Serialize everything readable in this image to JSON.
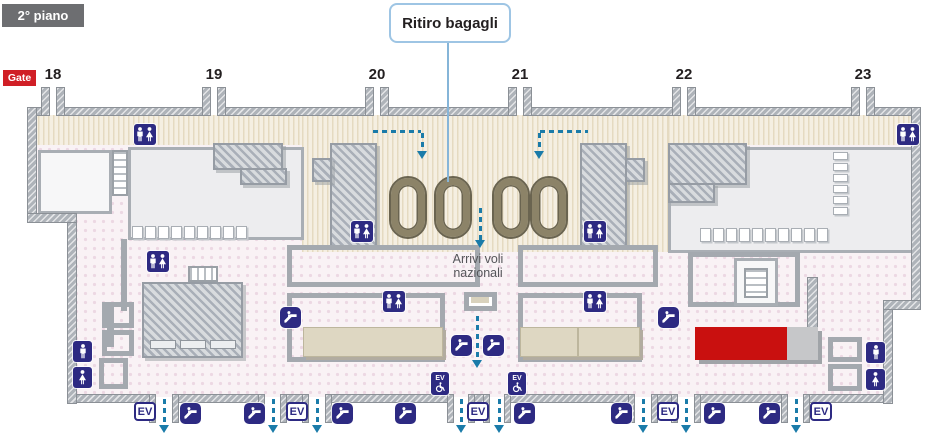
{
  "title": {
    "floor_label": "2° piano"
  },
  "callout": {
    "ritiro_bagagli": "Ritiro bagagli"
  },
  "annotations": {
    "arrivi_line1": "Arrivi voli",
    "arrivi_line2": "nazionali"
  },
  "gate": {
    "tag": "Gate",
    "numbers": [
      {
        "n": "18",
        "cx": 53,
        "gap": 49
      },
      {
        "n": "19",
        "cx": 214,
        "gap": 210
      },
      {
        "n": "20",
        "cx": 377,
        "gap": 373
      },
      {
        "n": "21",
        "cx": 520,
        "gap": 516
      },
      {
        "n": "22",
        "cx": 684,
        "gap": 680
      },
      {
        "n": "23",
        "cx": 863,
        "gap": 859
      }
    ],
    "gap_width": 8
  },
  "labels": {
    "ev": "EV"
  },
  "colors": {
    "icon_navy": "#2d2a82",
    "gate_red": "#d01f26",
    "highlight_red": "#c9100f",
    "arrow_blue": "#1a7ba9",
    "callout_border": "#9ec5e4",
    "corridor_beige": "#f5efe2",
    "floor_pink": "#f9f2f5",
    "wall_gray": "#aeb3b9",
    "carousel_olive": "#8c8368",
    "floor_label_gray": "#6d6e71"
  },
  "map": {
    "walls": {
      "top_y": 108,
      "top_segments": [
        [
          28,
          49
        ],
        [
          57,
          210
        ],
        [
          218,
          373
        ],
        [
          381,
          516
        ],
        [
          524,
          680
        ],
        [
          688,
          859
        ],
        [
          867,
          920
        ]
      ],
      "bottom_y": 395,
      "bottom_segments": [
        [
          68,
          155
        ],
        [
          173,
          264
        ],
        [
          281,
          308
        ],
        [
          326,
          453
        ],
        [
          469,
          489
        ],
        [
          505,
          634
        ],
        [
          652,
          677
        ],
        [
          695,
          787
        ],
        [
          804,
          888
        ]
      ],
      "bottom_gaps": [
        [
          155,
          173
        ],
        [
          264,
          281
        ],
        [
          308,
          326
        ],
        [
          453,
          469
        ],
        [
          489,
          505
        ],
        [
          634,
          652
        ],
        [
          677,
          695
        ],
        [
          787,
          804
        ]
      ],
      "verticals": [
        [
          28,
          108,
          113
        ],
        [
          68,
          214,
          189
        ],
        [
          912,
          108,
          200
        ],
        [
          884,
          301,
          102
        ]
      ],
      "jogs": [
        [
          28,
          214,
          48
        ],
        [
          884,
          301,
          36
        ]
      ]
    },
    "carousels": {
      "y": 178,
      "xs": [
        391,
        436,
        494,
        532
      ]
    },
    "icons": {
      "wc": [
        [
          134,
          124
        ],
        [
          897,
          124
        ],
        [
          351,
          221
        ],
        [
          584,
          221
        ],
        [
          147,
          251
        ],
        [
          383,
          291
        ],
        [
          584,
          291
        ]
      ],
      "man": [
        [
          73,
          341
        ],
        [
          866,
          342
        ]
      ],
      "woman": [
        [
          73,
          367
        ],
        [
          866,
          369
        ]
      ],
      "escalator": [
        [
          280,
          307
        ],
        [
          658,
          307
        ],
        [
          451,
          335
        ],
        [
          483,
          335
        ],
        [
          180,
          403
        ],
        [
          244,
          403
        ],
        [
          332,
          403
        ],
        [
          395,
          403
        ],
        [
          514,
          403
        ],
        [
          611,
          403
        ],
        [
          704,
          403
        ],
        [
          759,
          403
        ]
      ],
      "ev_box": [
        [
          134,
          402
        ],
        [
          286,
          402
        ],
        [
          467,
          402
        ],
        [
          657,
          402
        ],
        [
          810,
          402
        ]
      ],
      "ev_access": [
        [
          431,
          372
        ],
        [
          508,
          372
        ]
      ]
    },
    "arrows": {
      "bottom_xs": [
        164,
        273,
        317,
        461,
        499,
        643,
        686,
        796
      ],
      "bottom_y": 399,
      "bottom_len": 26,
      "center_long": {
        "x": 477,
        "y": 316,
        "len": 44
      },
      "center_upper": {
        "x": 480,
        "y": 208,
        "len": 32
      },
      "flow_left": {
        "hx": 373,
        "hw": 48,
        "vx": 421,
        "y": 130,
        "vlen": 18
      },
      "flow_right": {
        "hx": 540,
        "hw": 48,
        "vx": 538,
        "y": 130,
        "vlen": 18
      }
    },
    "seats": {
      "rows": [
        {
          "x": 132,
          "y": 226,
          "n": 9,
          "dx": 13,
          "w": 11,
          "h": 13
        },
        {
          "x": 700,
          "y": 228,
          "n": 10,
          "dx": 13,
          "w": 11,
          "h": 14
        }
      ],
      "col": {
        "x": 833,
        "y": 152,
        "n": 6,
        "dy": 11,
        "w": 15,
        "h": 8
      }
    },
    "highlight": {
      "x": 695,
      "y": 327,
      "red_w": 92,
      "gray_w": 31,
      "h": 33
    }
  }
}
